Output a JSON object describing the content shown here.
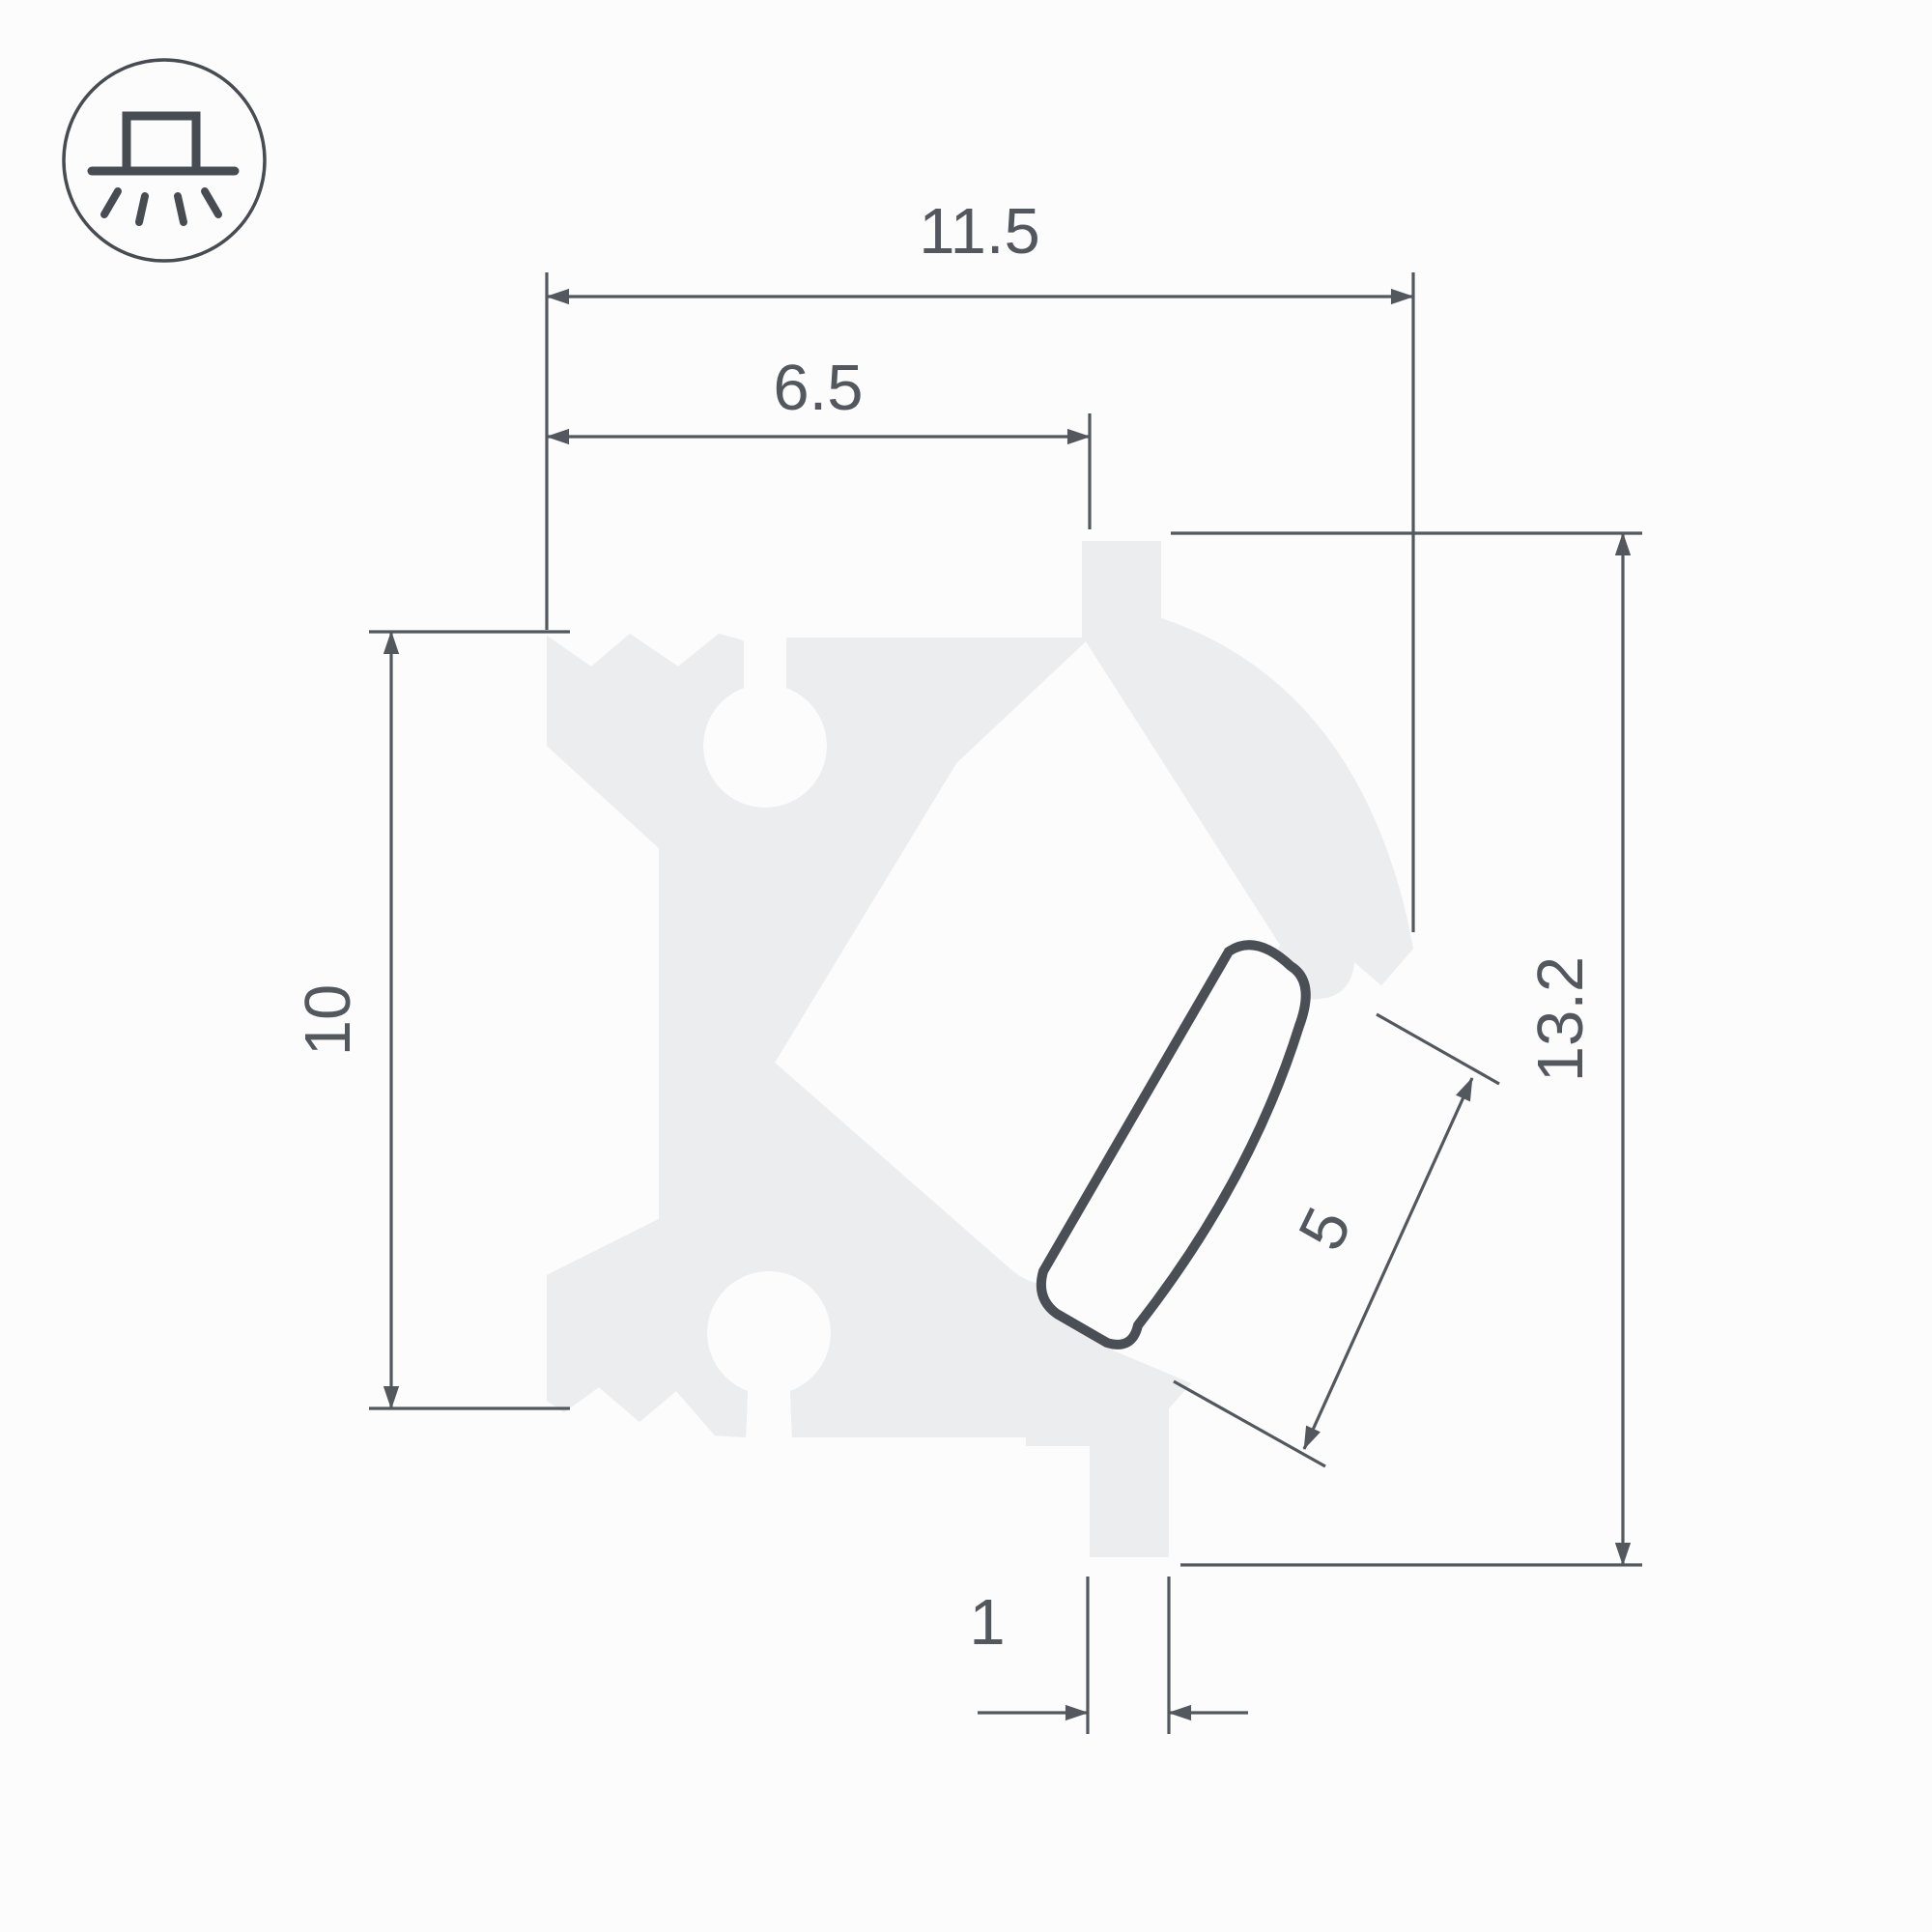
{
  "drawing": {
    "title_hint": "LED profile cross-section technical drawing",
    "icon": {
      "name": "surface-mount-light-icon"
    },
    "dimensions": {
      "total_width": "11.5",
      "inner_width": "6.5",
      "left_height": "10",
      "total_height": "13.2",
      "lens_width": "5",
      "foot_width": "1"
    },
    "colors": {
      "outline_ink": "#4a4f55",
      "dimension_ink": "#53585e",
      "material_fill": "#ecedee",
      "background": "#fcfcfd"
    }
  }
}
